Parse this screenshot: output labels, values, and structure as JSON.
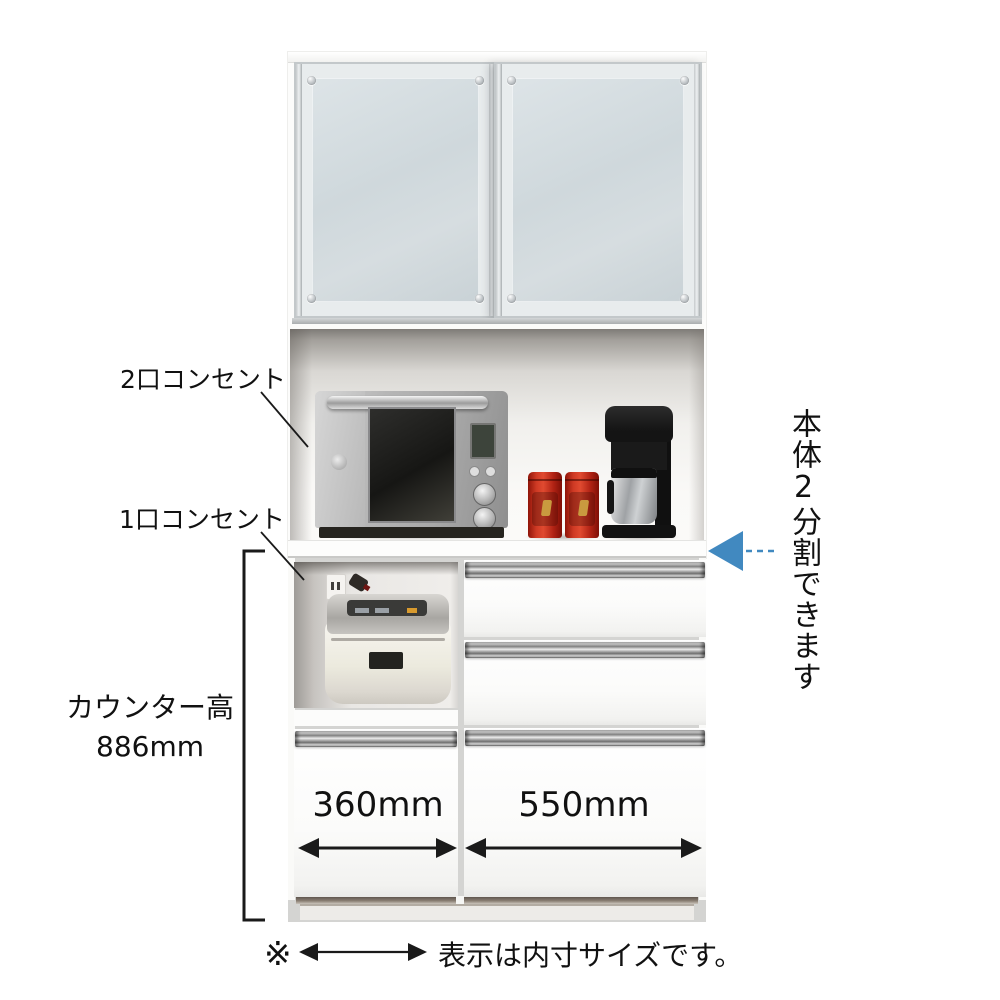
{
  "labels": {
    "outlet_2": "2口コンセント",
    "outlet_1": "1口コンセント",
    "counter_height_title": "カウンター高",
    "counter_height_value": "886mm",
    "inner_width_left": "360mm",
    "inner_width_right": "550mm",
    "split_note_vertical": "本体2分割できます",
    "legend_mark": "※",
    "legend_text": "表示は内寸サイズです。"
  },
  "colors": {
    "accent_blue": "#4189c0",
    "line": "#1a1a1a",
    "background": "#ffffff"
  },
  "icons": {
    "split_arrow": "blue-left-arrow-with-dashed-tail",
    "width_arrow_left": "double-headed-arrow",
    "width_arrow_right": "double-headed-arrow",
    "legend_arrow": "double-headed-arrow"
  }
}
